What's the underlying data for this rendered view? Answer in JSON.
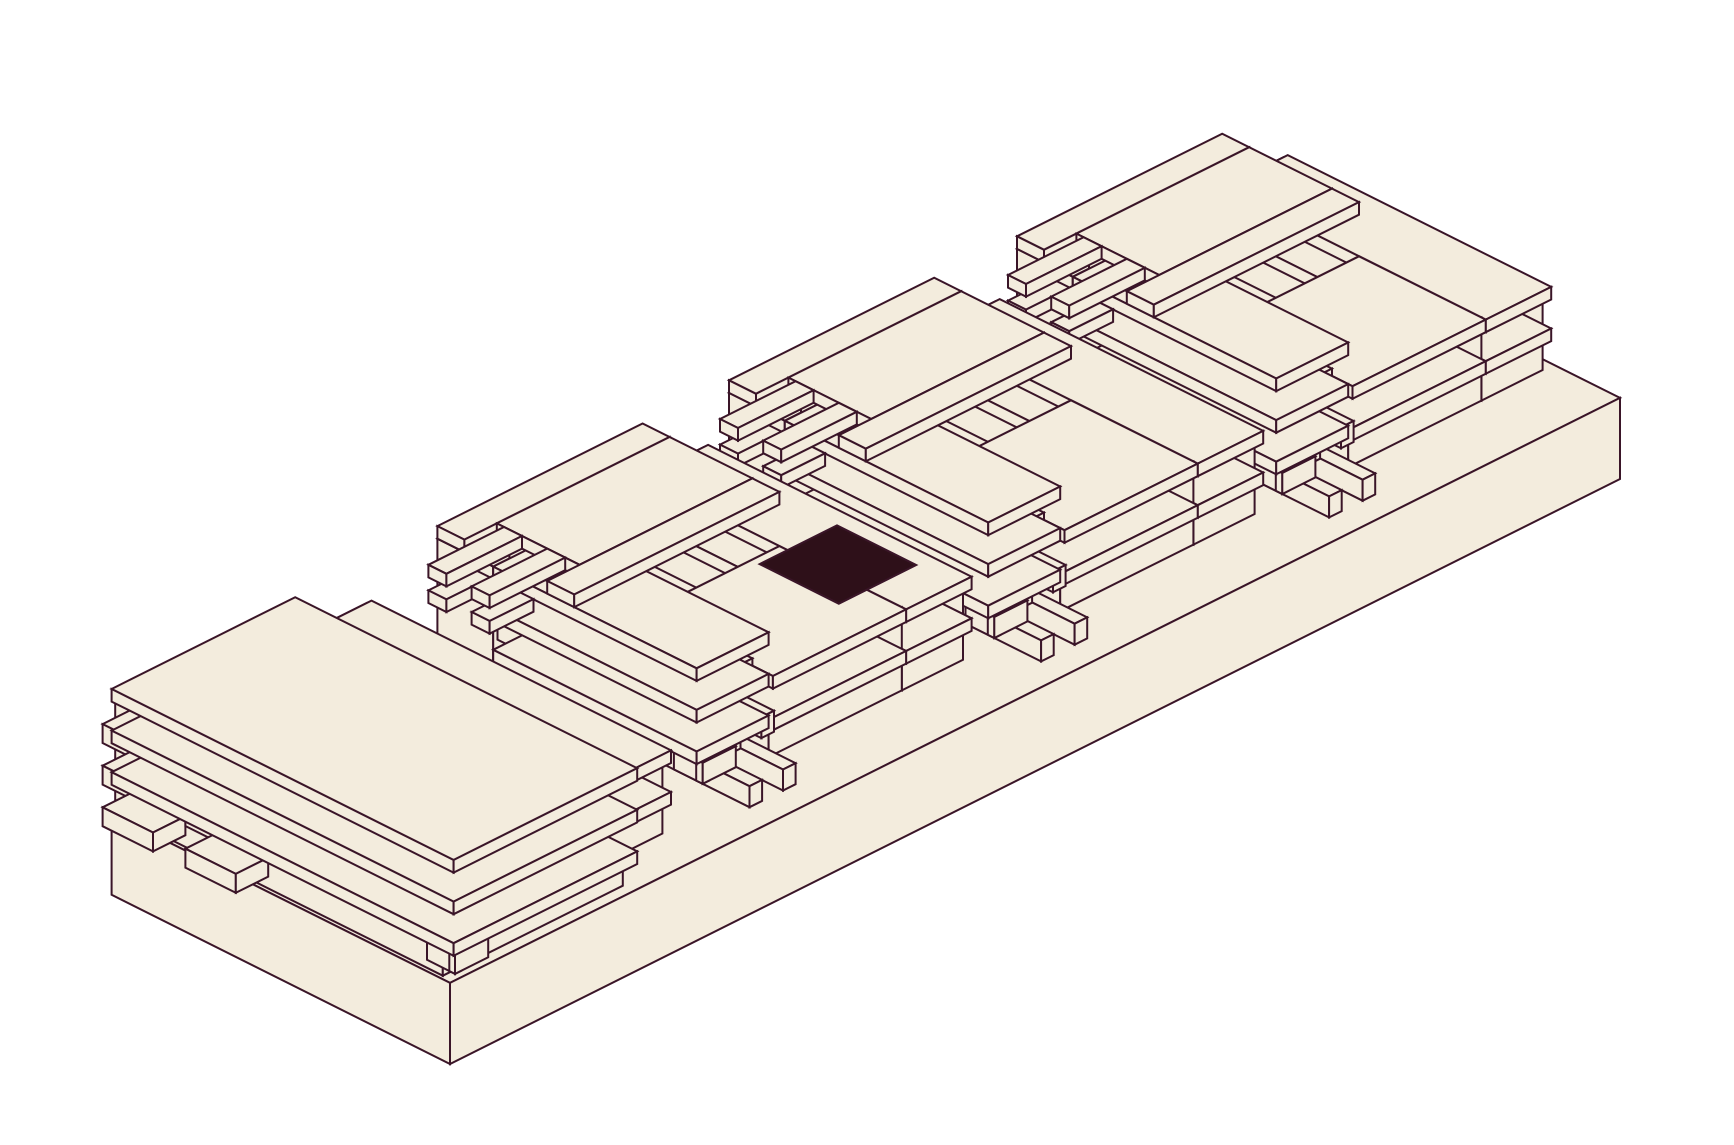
{
  "description": "Isometric architectural illustration: four cream-colored modernist building modules with stacked floor slabs, cantilevered beams, balcony rails and corner fins, arranged on one long rectangular base platform; a single dark rectangular skylight patch sits on the lower deck of the second module; flat cream fill with dark plum outlines on a white background.",
  "palette": {
    "background": "#ffffff",
    "surface": "#f3ecdd",
    "line": "#3a1528",
    "dark_patch": "#2e1019"
  },
  "stroke_width": 2,
  "projection": {
    "origin_x": 111.6,
    "origin_y": 894.8,
    "unit_x": 36,
    "unit_y": 18,
    "unit_z": 42
  },
  "scene": {
    "base_box": [
      0,
      32.5,
      0,
      9.4,
      0,
      1.93
    ],
    "module_b_origins": [
      24.8,
      16.8,
      8.7
    ],
    "module_b_template": [
      [
        0.0,
        2.0,
        0.35,
        1.9,
        1.93,
        4.9
      ],
      [
        2.0,
        5.7,
        0.35,
        4.15,
        1.93,
        4.9
      ],
      [
        5.7,
        7.4,
        0.35,
        7.55,
        1.93,
        3.91
      ],
      [
        5.7,
        7.52,
        0.35,
        7.67,
        2.62,
        2.92
      ],
      [
        5.7,
        7.52,
        0.35,
        7.67,
        3.61,
        3.91
      ],
      [
        2.0,
        5.7,
        4.15,
        7.55,
        1.93,
        3.91
      ],
      [
        2.0,
        5.7,
        4.15,
        7.67,
        2.62,
        2.92
      ],
      [
        2.0,
        5.7,
        4.15,
        7.67,
        3.61,
        3.91
      ],
      [
        1.05,
        1.4,
        1.9,
        7.7,
        4.1,
        4.6
      ],
      [
        1.05,
        1.4,
        1.9,
        8.3,
        3.11,
        3.61
      ],
      [
        1.05,
        1.4,
        1.9,
        8.9,
        2.12,
        2.62
      ],
      [
        0.12,
        0.47,
        1.9,
        7.7,
        4.1,
        4.6
      ],
      [
        0.12,
        0.47,
        1.9,
        8.3,
        3.11,
        3.61
      ],
      [
        0.12,
        0.47,
        1.9,
        8.9,
        2.12,
        2.62
      ],
      [
        0.12,
        0.3,
        6.8,
        7.6,
        4.1,
        4.6
      ],
      [
        0.12,
        1.04,
        7.42,
        7.6,
        4.1,
        4.6
      ],
      [
        0.12,
        0.3,
        6.8,
        7.6,
        3.11,
        3.61
      ],
      [
        0.12,
        1.04,
        7.42,
        7.6,
        3.11,
        3.61
      ],
      [
        0.12,
        0.3,
        6.8,
        7.6,
        2.12,
        2.62
      ],
      [
        0.12,
        1.04,
        7.42,
        7.6,
        2.12,
        2.62
      ],
      [
        0.0,
        2.0,
        1.9,
        7.55,
        2.62,
        2.92
      ],
      [
        0.0,
        2.0,
        1.9,
        7.55,
        3.61,
        3.91
      ],
      [
        0.0,
        2.0,
        1.9,
        7.55,
        4.6,
        4.9
      ],
      [
        0.0,
        5.7,
        0.35,
        1.1,
        4.9,
        5.2
      ],
      [
        0.9,
        5.7,
        1.1,
        3.4,
        4.9,
        5.2
      ],
      [
        0.0,
        5.7,
        3.4,
        4.15,
        4.9,
        5.2
      ],
      [
        -1.2,
        0.02,
        1.3,
        1.8,
        4.29,
        4.59
      ],
      [
        -1.2,
        0.02,
        2.5,
        3.0,
        4.29,
        4.59
      ],
      [
        -1.2,
        0.9,
        1.3,
        1.8,
        4.9,
        5.2
      ],
      [
        -1.2,
        0.9,
        2.5,
        3.0,
        4.9,
        5.2
      ]
    ],
    "dark_patches": [
      {
        "rect": [
          13.6,
          15.75,
          4.4,
          6.6
        ],
        "z": 3.93
      }
    ],
    "module_a_boxes": [
      [
        0.1,
        5.1,
        0.0,
        9.1,
        1.93,
        4.6
      ],
      [
        5.1,
        7.1,
        0.0,
        8.2,
        1.93,
        3.91
      ],
      [
        5.1,
        7.22,
        0.0,
        8.32,
        2.62,
        2.92
      ],
      [
        5.1,
        7.22,
        0.0,
        8.32,
        3.61,
        3.91
      ],
      [
        -0.75,
        0.15,
        0.5,
        1.9,
        4.15,
        4.6
      ],
      [
        -0.75,
        0.15,
        0.5,
        1.9,
        3.16,
        3.61
      ],
      [
        -0.75,
        0.15,
        0.5,
        1.9,
        2.17,
        2.62
      ],
      [
        -0.75,
        0.15,
        2.8,
        4.2,
        4.15,
        4.6
      ],
      [
        -0.75,
        0.15,
        2.8,
        4.2,
        3.16,
        3.61
      ],
      [
        -0.75,
        0.15,
        2.8,
        4.2,
        2.17,
        2.62
      ],
      [
        0.1,
        0.28,
        8.66,
        9.44,
        4.1,
        4.6
      ],
      [
        0.1,
        1.02,
        9.28,
        9.44,
        4.1,
        4.6
      ],
      [
        0.1,
        0.28,
        8.66,
        9.44,
        3.11,
        3.61
      ],
      [
        0.1,
        1.02,
        9.28,
        9.44,
        3.11,
        3.61
      ],
      [
        0.1,
        0.28,
        8.66,
        9.44,
        2.12,
        2.62
      ],
      [
        0.1,
        1.02,
        9.28,
        9.44,
        2.12,
        2.62
      ],
      [
        0.0,
        5.1,
        0.0,
        9.5,
        2.62,
        2.92
      ],
      [
        0.0,
        5.1,
        0.0,
        9.5,
        3.61,
        3.91
      ],
      [
        0.0,
        5.1,
        0.0,
        9.5,
        4.6,
        4.9
      ]
    ]
  },
  "canvas": {
    "width": 1734,
    "height": 1145
  }
}
